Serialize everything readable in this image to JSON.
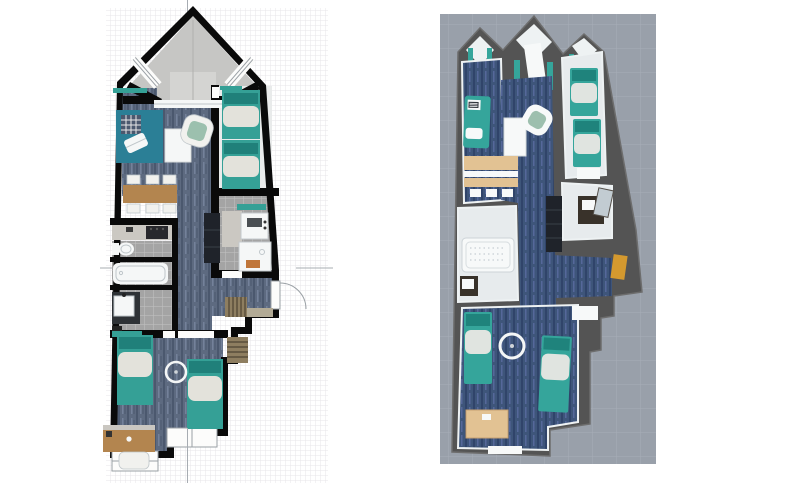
{
  "workspace": {
    "label": "Floor plan editor - split view",
    "left_view": "2D floor plan",
    "right_view": "3D aerial view"
  },
  "colors": {
    "wall2d": "#0a0a0a",
    "grid_line": "#e7e5e9",
    "axis_line": "#a7acb2",
    "carpet_base": "#5d6a80",
    "carpet_dark": "#4b586e",
    "carpet_light": "#74819a",
    "bay_floor": "#c6c6c4",
    "bay_step": "#d4d4d2",
    "tile_base": "#a4a4a4",
    "tile_grout": "#c3c3c3",
    "white_fixture": "#f5f7f7",
    "fixture_line": "#bfc6ca",
    "teal": "#35a096",
    "teal_dark": "#20807a",
    "rug_teal": "#2b7f96",
    "sage": "#9cc0ae",
    "blanket": "#e3e2db",
    "wood": "#b3854f",
    "counter": "#cbc8c2",
    "appliance_dark": "#28282c",
    "cabinet_dark": "#1f232a",
    "chair_white": "#f1f1ee",
    "door_white": "#fcfcfb",
    "door_frame": "#9aa0a5",
    "mat_orange": "#c0763a",
    "doormat": "#b2aa95",
    "slat_wood": "#8e7e60",
    "slat_line": "#4e4433",
    "ground3d": "#99a0aa",
    "ground3d_line": "#a8aeb8",
    "wall3d": "#545454",
    "wall3d_edge": "#6d6d6d",
    "innerwall3d": "#eef2f3",
    "carpet3d_base": "#3e557a",
    "carpet3d_dark": "#30446a",
    "carpet3d_light": "#55689a",
    "tile3d": "#e7ebed",
    "wood3d": "#e2c293",
    "teal3d": "#35a59b",
    "teal3d_dark": "#1f837c",
    "blanket3d": "#e0e4e0",
    "mirror3d": "#c2ccd2",
    "vanity3d": "#39322a",
    "orange3d": "#d4992f",
    "white3d": "#f7f9f9",
    "sage3d": "#9dbfae"
  },
  "plan2d": {
    "name": "2D floor plan canvas",
    "grid_cell_px": 5,
    "rooms": [
      "bay-window-nook",
      "living-dining-room",
      "right-bedroom",
      "kitchen",
      "wc",
      "bathroom",
      "shower-room",
      "hallway",
      "entrance",
      "lower-bedroom"
    ],
    "furniture": [
      "chaise-lounge",
      "area-rug",
      "coffee-table",
      "armchair",
      "dining-table",
      "dining-chairs-x6",
      "kitchen-counter",
      "cooktop",
      "tall-cabinet",
      "toilet",
      "bathtub",
      "washbasin-vanity",
      "sink-unit",
      "shower-tray",
      "bath-mat",
      "entrance-door",
      "doormat",
      "slatted-shelf-x2",
      "single-bed-x4",
      "ceiling-lamp",
      "desk",
      "desk-chair",
      "gable-window-x2",
      "bottom-window-x2"
    ]
  },
  "view3d": {
    "name": "3D aerial view canvas",
    "ground": "gray tiled plane",
    "rooms": [
      "gable-nooks-x3",
      "living-dining-room",
      "right-bedroom",
      "shower-room",
      "bathroom",
      "hallway",
      "entrance",
      "lower-bedroom"
    ],
    "furniture": [
      "teal-curtains",
      "chaise-lounge-with-laptop",
      "side-table",
      "armchair",
      "sideboard",
      "dining-chairs",
      "tall-wardrobe",
      "single-bed-x4",
      "bedside-bench",
      "vanity-with-mirror",
      "bathtub",
      "washbasin",
      "coat-rack",
      "ceiling-lamp",
      "desk",
      "bedroom-door"
    ]
  }
}
